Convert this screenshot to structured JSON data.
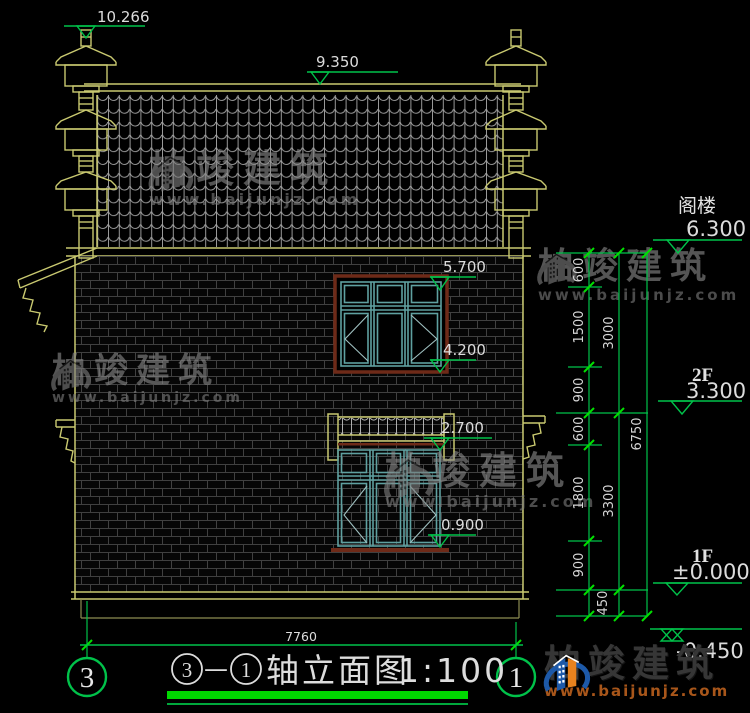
{
  "title": {
    "axis_start": "3",
    "dash": "—",
    "axis_end": "1",
    "name": "轴立面图",
    "scale": "1:100"
  },
  "axis_bubbles": {
    "left": "3",
    "right": "1"
  },
  "markers": {
    "finial_top": "10.266",
    "ridge": "9.350",
    "upper_window_top": "5.700",
    "upper_window_bottom": "4.200",
    "canopy_top": "2.700",
    "lower_window_bottom": "0.900"
  },
  "levels": {
    "attic_label": "阁楼",
    "attic_value": "6.300",
    "f2_label": "2F",
    "f2_value": "3.300",
    "f1_label": "1F",
    "f1_value": "±0.000",
    "base_value": "-0.450"
  },
  "dims": {
    "segments": [
      "600",
      "1500",
      "900",
      "600",
      "1800",
      "900",
      "450"
    ],
    "subtotal_upper": "3000",
    "subtotal_lower": "3300",
    "total": "6750",
    "width": "7760"
  },
  "watermark": {
    "brand": "柏竣建筑",
    "site": "www.baijunjz.com"
  },
  "logo": {
    "brand": "柏竣建筑",
    "site": "www.baijunjz.com"
  },
  "colors": {
    "line_yellow": "#c9c970",
    "line_green": "#00c24a",
    "underline_green": "#00d800",
    "frame_cyan": "#5fa0a0",
    "frame_maroon": "#6e2a18",
    "text_white": "#dcdcdc",
    "logo_blue": "#1d59a8",
    "logo_orange": "#e8821e"
  }
}
